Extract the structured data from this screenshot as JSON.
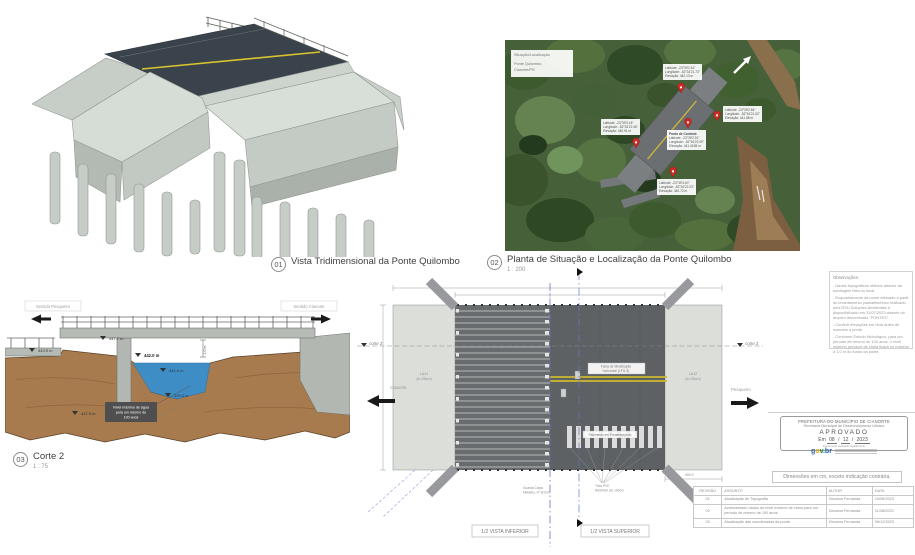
{
  "captions": {
    "c01": {
      "num": "01",
      "title": "Vista Tridimensional da Ponte Quilombo"
    },
    "c02": {
      "num": "02",
      "title": "Planta de Situação e Localização da Ponte Quilombo",
      "scale": "1 : 200"
    },
    "c03": {
      "num": "03",
      "title": "Corte 2",
      "scale": "1 : 75"
    }
  },
  "aerial": {
    "info": [
      "Situação/Localização",
      "Ponte Quilombo,",
      "Cianorte/PR"
    ],
    "pins": [
      {
        "lines": [
          "Latitude: -23°39'2.61\"",
          "Longitude: -52°34'21.73\"",
          "Elevação: 442.13 m"
        ]
      },
      {
        "lines": [
          "Latitude: -23°39'2.84\"",
          "Longitude: -52°34'21.52\"",
          "Elevação: 441.88 m"
        ]
      },
      {
        "title": "Ponto de Controle",
        "lines": [
          "Latitude: -23°39'2.91\"",
          "Longitude: -52°34'22.09\"",
          "Elevação: 441.4158 m"
        ]
      },
      {
        "lines": [
          "Latitude: -23°39'3.18\"",
          "Longitude: -52°34'22.46\"",
          "Elevação: 440.91 m"
        ]
      },
      {
        "lines": [
          "Latitude: -23°39'3.40\"",
          "Longitude: -52°34'22.23\"",
          "Elevação: 440.72 m"
        ]
      }
    ]
  },
  "corte": {
    "dir_left": "Sentido Pesqueiro",
    "dir_right": "Sentido Cianorte",
    "elev_deck": "447.7 m",
    "elev_approach": "443.9 m",
    "elev_flood": "442.0 m",
    "elev_water": "441.0 m",
    "elev_bed": "439.3 m",
    "elev_pile": "437.9 m",
    "dim": "1.0 m",
    "note_l1": "Nível máximo de água",
    "note_l2": "para um retorno de",
    "note_l3": "100 anos"
  },
  "plan": {
    "corte_label": "corte 2",
    "dir_left": "Cianorte",
    "dir_right": "Pesqueiro",
    "slab_left_l1": "LAJ1",
    "slab_left_l2": "(e=25cm)",
    "slab_right_l1": "LAJ2",
    "slab_right_l2": "(e=25cm)",
    "faixa_l1": "Faixa de Sinalização",
    "faixa_l2": "horizontal (LFO-3)",
    "pavimento": "Pavimento em Paralelepípedo",
    "tubo_l1": "Tubo PVC",
    "tubo_l2": "Ø100mm a/c 100cm",
    "guarda_l1": "Guarda Corpo",
    "guarda_l2": "Metálico, h=110cm",
    "dim_right": "400.0",
    "vista_inferior": "1/2 VISTA INFERIOR",
    "vista_superior": "1/2 VISTA SUPERIOR"
  },
  "observacoes": {
    "title": "Observações:",
    "items": [
      "- Dados topográficos obtidos através da sondagem feita no local.",
      "- Enquadramento da ponte efetuado a partir do levantamento planialtimétrico realizado pela RSU Soluções Ambientais e disponibilizado em 31/07/2023 através do arquivo denominado \"PONTES\".",
      "- Conferir elevações em obra antes de executar a ponte.",
      "- Conforme Estudo Hidrológico, para um período de retorno de 100 anos, o nível máximo provável de cheia ficará no máximo a 1,0 m do fundo da ponte."
    ]
  },
  "stamp": {
    "line1": "PREFEITURA DO MUNICÍPIO DE CIANORTE",
    "line2": "Secretaria Municipal de Desenvolvimento Urbano",
    "approved": "APROVADO",
    "em": "Em",
    "day": "08",
    "month": "12",
    "year": "2023",
    "signed": "Documento assinado digitalmente",
    "logo_g": "g",
    "logo_o": "o",
    "logo_v": "v",
    "logo_br": ".br"
  },
  "revisions": {
    "note": "Dimensões em cm, exceto indicação contrária.",
    "headers": [
      "REVISÃO",
      "ASSUNTO",
      "AUTOR",
      "DATA"
    ],
    "rows": [
      {
        "rev": "01",
        "assunto": "Atualização de Topografia",
        "autor": "Giovana Fernanda",
        "data": "10/08/2023"
      },
      {
        "rev": "02",
        "assunto": "Acrescentado dados do nível máximo de cheia para um período de retorno de 100 anos.",
        "autor": "Giovana Fernanda",
        "data": "11/08/2023"
      },
      {
        "rev": "03",
        "assunto": "Atualização das coordenadas da ponte.",
        "autor": "Giovana Fernanda",
        "data": "06/12/2023"
      }
    ]
  },
  "colors": {
    "accent_yellow": "#cdb92f",
    "water_blue": "#3e8ec5",
    "earth_brown": "#a87b4e",
    "pin_red": "#cc2a22",
    "govbr_blue": "#2864ae",
    "govbr_yellow": "#f2a818",
    "govbr_green": "#168821"
  }
}
